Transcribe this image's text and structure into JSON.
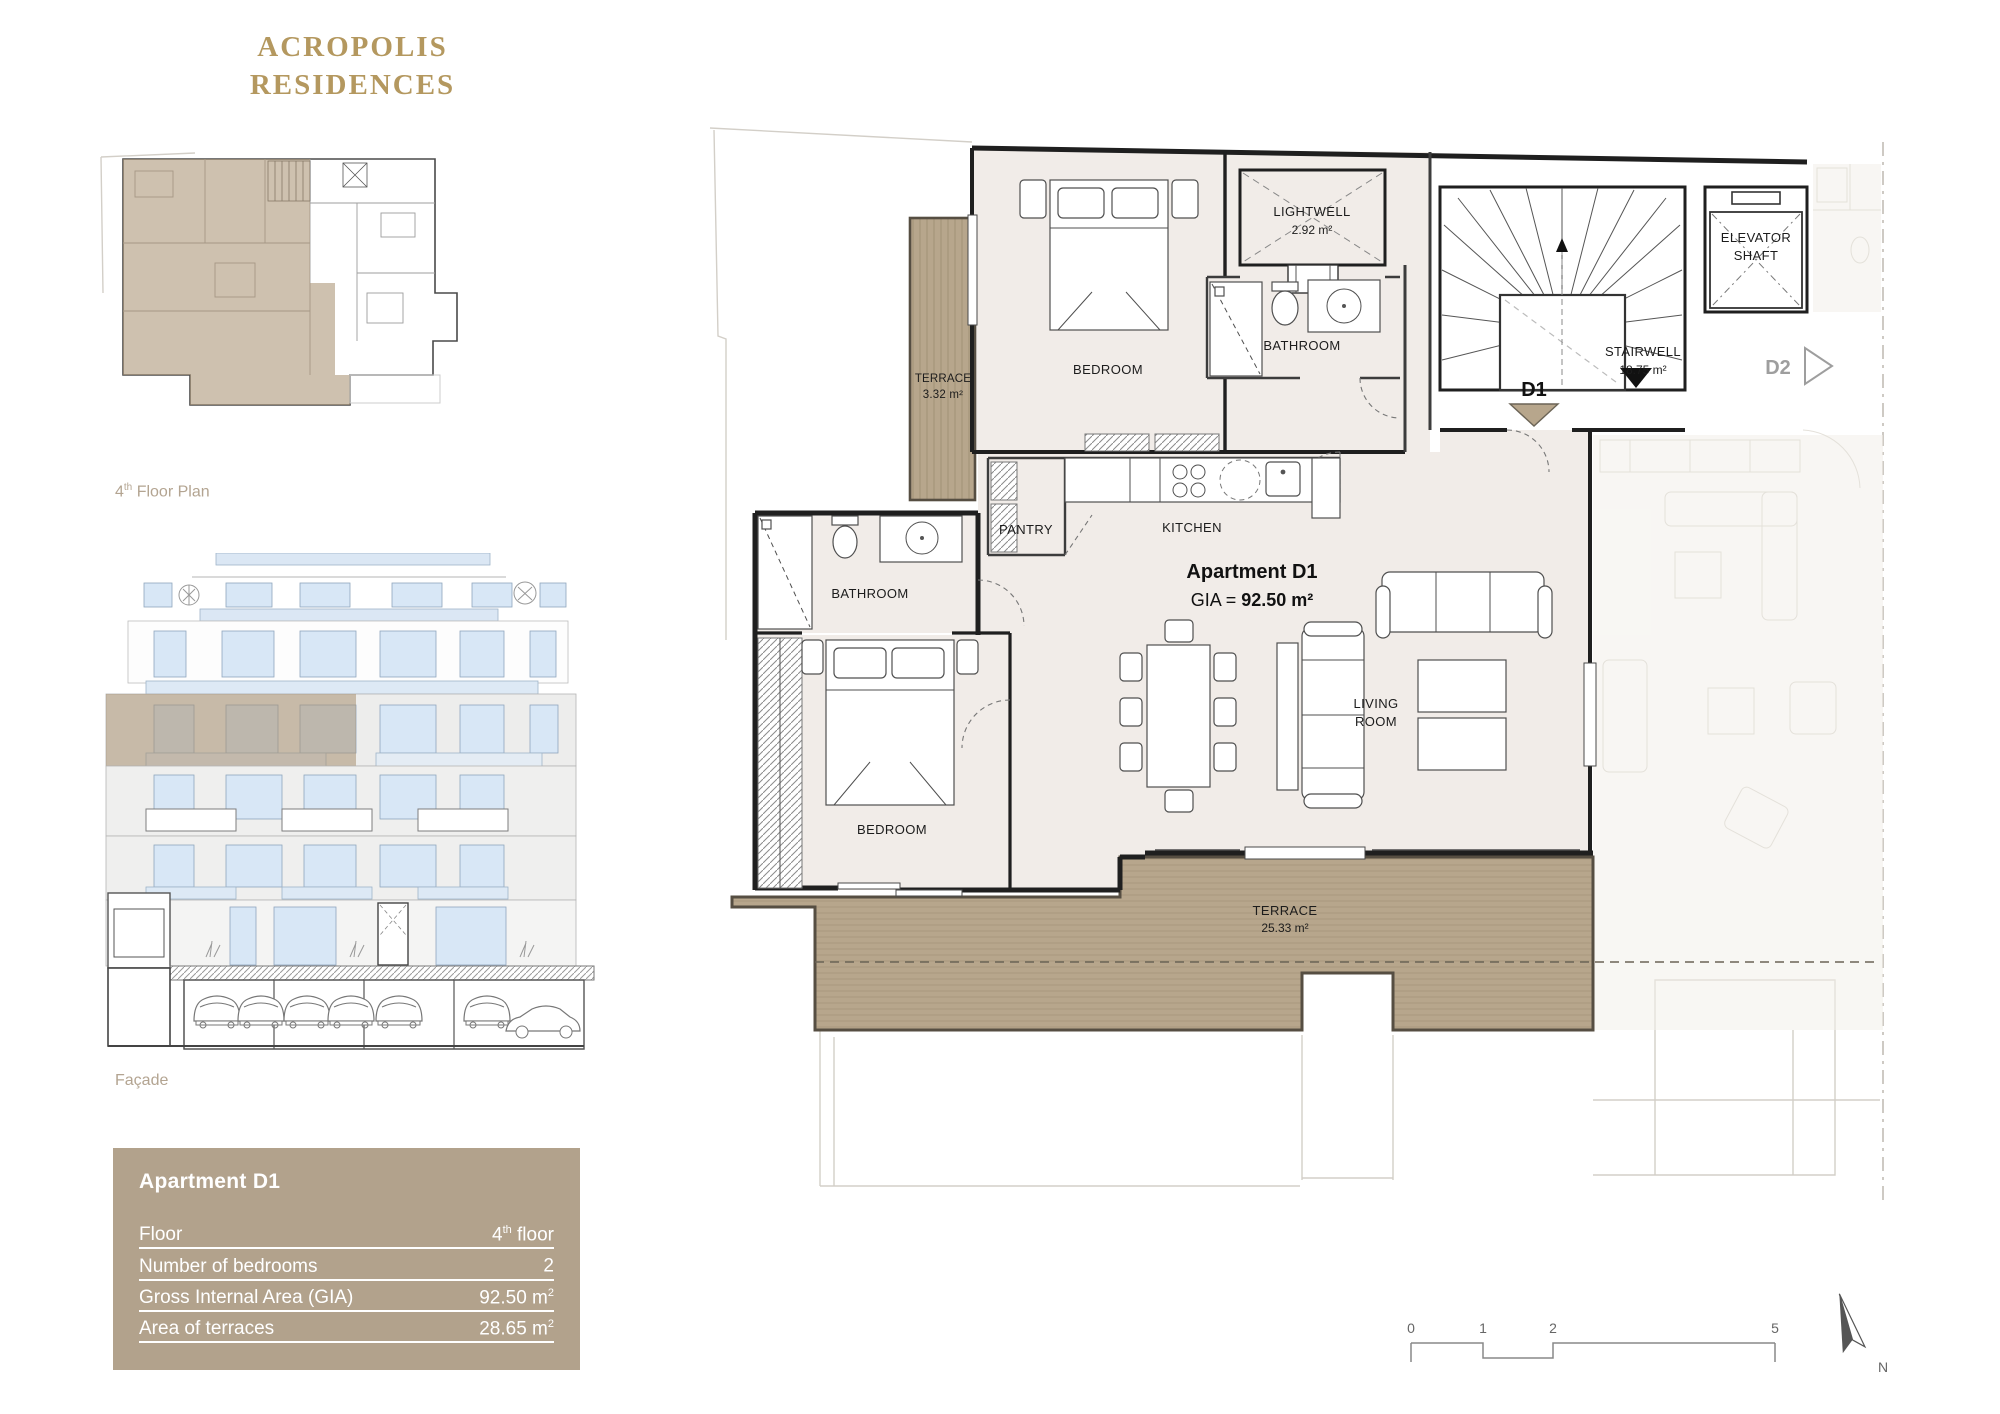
{
  "brand": {
    "line1": "ACROPOLIS",
    "line2": "RESIDENCES"
  },
  "captions": {
    "floor_plan_num": "4",
    "floor_plan_sup": "th",
    "floor_plan_rest": " Floor Plan",
    "facade": "Façade"
  },
  "info_panel": {
    "title": "Apartment D1",
    "rows": [
      {
        "label": "Floor",
        "value_main": "4",
        "value_sup": "th",
        "value_rest": " floor"
      },
      {
        "label": "Number of bedrooms",
        "value_main": "2",
        "value_sup": "",
        "value_rest": ""
      },
      {
        "label": "Gross Internal Area (GIA)",
        "value_main": "92.50 m",
        "value_sup": "2",
        "value_rest": ""
      },
      {
        "label": "Area of terraces",
        "value_main": "28.65 m",
        "value_sup": "2",
        "value_rest": ""
      }
    ]
  },
  "plan": {
    "apartment_label": {
      "title": "Apartment D1",
      "gia_prefix": "GIA = ",
      "gia_value": "92.50 m²"
    },
    "rooms": {
      "terrace_top_name": "TERRACE",
      "terrace_top_area": "3.32 m²",
      "bedroom_top": "BEDROOM",
      "lightwell_name": "LIGHTWELL",
      "lightwell_area": "2.92 m²",
      "bathroom_top": "BATHROOM",
      "stairwell_name": "STAIRWELL",
      "stairwell_area": "18.75 m²",
      "elevator_line1": "ELEVATOR",
      "elevator_line2": "SHAFT",
      "pantry": "PANTRY",
      "kitchen": "KITCHEN",
      "bathroom_left": "BATHROOM",
      "bedroom_left": "BEDROOM",
      "living_line1": "LIVING",
      "living_line2": "ROOM",
      "terrace_main_name": "TERRACE",
      "terrace_main_area": "25.33 m²"
    },
    "units": {
      "d1": "D1",
      "d2": "D2"
    },
    "scale_ticks": [
      "0",
      "1",
      "2",
      "5"
    ],
    "north_label": "N"
  },
  "colors": {
    "accent_gold": "#b4985f",
    "panel_bg": "#b2a28c",
    "terrace_fill": "#b7a68c",
    "interior_fill": "#f1ece8",
    "wall": "#1f1f1f",
    "window_blue": "#d8e7f6",
    "d2_gray": "#9e9e9e"
  }
}
